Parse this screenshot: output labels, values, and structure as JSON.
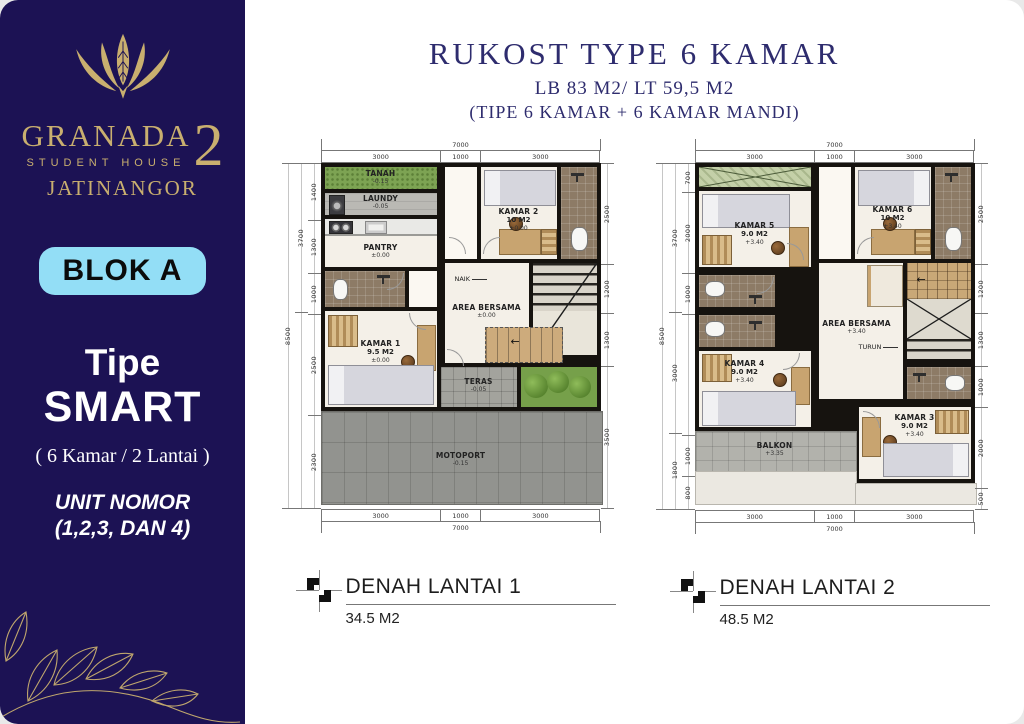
{
  "sidebar": {
    "brand": "GRANADA",
    "brand_number": "2",
    "brand_sub": "STUDENT HOUSE",
    "brand_city": "JATINANGOR",
    "blok_badge": "BLOK A",
    "tipe_label": "Tipe",
    "tipe_name": "SMART",
    "tipe_detail": "( 6 Kamar / 2 Lantai )",
    "unit_line1": "UNIT NOMOR",
    "unit_line2": "(1,2,3, DAN 4)"
  },
  "header": {
    "title": "RUKOST TYPE 6 KAMAR",
    "subtitle": "LB 83 M2/ LT 59,5 M2",
    "subtitle2": "(TIPE 6 KAMAR + 6 KAMAR MANDI)"
  },
  "colors": {
    "sidebar_navy": "#1c1254",
    "brand_gold": "#c9af6f",
    "badge_blue": "#93def6",
    "title_navy": "#2e2c6e",
    "floor_cream": "#f4f0e8",
    "bath_tile_brown": "#8d7b66",
    "grass_green": "#7da353",
    "paving_gray": "#92938f"
  },
  "plans": [
    {
      "caption": "DENAH LANTAI 1",
      "caption_area": "34.5 M2",
      "dims": {
        "top_total": "7000",
        "top": [
          "3000",
          "1000",
          "3000"
        ],
        "bottom": [
          "3000",
          "1000",
          "3000"
        ],
        "bottom_total": "7000",
        "left_total": "8500",
        "left_group": [
          "3700",
          ""
        ],
        "left": [
          "1400",
          "1300",
          "1000",
          "2500",
          "2300"
        ],
        "right": [
          "2500",
          "1200",
          "1300",
          "3500"
        ]
      },
      "rooms": {
        "tanah": {
          "label": "TANAH",
          "level": "-0.15"
        },
        "laundy": {
          "label": "LAUNDY",
          "level": "-0.05"
        },
        "pantry": {
          "label": "PANTRY",
          "level": "±0.00"
        },
        "kamar2": {
          "label": "KAMAR 2",
          "area": "10 M2",
          "level": "±0.00"
        },
        "kamar1": {
          "label": "KAMAR 1",
          "area": "9.5 M2",
          "level": "±0.00"
        },
        "area_bersama": {
          "label": "AREA BERSAMA",
          "level": "±0.00"
        },
        "teras": {
          "label": "TERAS",
          "level": "-0.05"
        },
        "motoport": {
          "label": "MOTOPORT",
          "level": "-0.15"
        },
        "naik": "NAIK"
      }
    },
    {
      "caption": "DENAH LANTAI 2",
      "caption_area": "48.5 M2",
      "dims": {
        "top_total": "7000",
        "top": [
          "3000",
          "1000",
          "3000"
        ],
        "bottom": [
          "3000",
          "1000",
          "3000"
        ],
        "bottom_total": "7000",
        "left_total": "8500",
        "left_group": [
          "3700",
          "3000",
          "1800"
        ],
        "left": [
          "700",
          "2000",
          "1000",
          "",
          "1000",
          "800"
        ],
        "right": [
          "2500",
          "1200",
          "1300",
          "1000",
          "2000",
          "500"
        ]
      },
      "rooms": {
        "kamar5": {
          "label": "KAMAR 5",
          "area": "9.0 M2",
          "level": "+3.40"
        },
        "kamar6": {
          "label": "KAMAR 6",
          "area": "10 M2",
          "level": "+3.40"
        },
        "area_bersama": {
          "label": "AREA BERSAMA",
          "level": "+3.40"
        },
        "kamar4": {
          "label": "KAMAR 4",
          "area": "9.0 M2",
          "level": "+3.40"
        },
        "kamar3": {
          "label": "KAMAR 3",
          "area": "9.0 M2",
          "level": "+3.40"
        },
        "balkon": {
          "label": "BALKON",
          "level": "+3.35"
        },
        "turun": "TURUN"
      }
    }
  ]
}
